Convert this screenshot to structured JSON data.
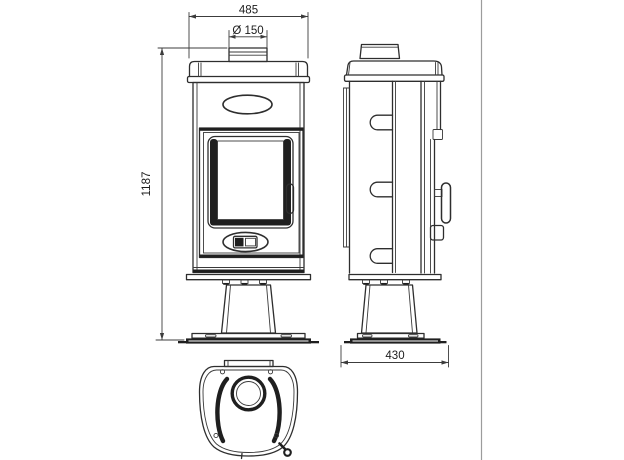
{
  "drawing": {
    "dimensions": {
      "width": "485",
      "flue": "Ø 150",
      "height": "1187",
      "depth": "430"
    },
    "colors": {
      "line": "#2e2e2e",
      "dimension": "#3c3c3c",
      "background": "#ffffff",
      "frame_border": "#9c9c9c"
    }
  }
}
